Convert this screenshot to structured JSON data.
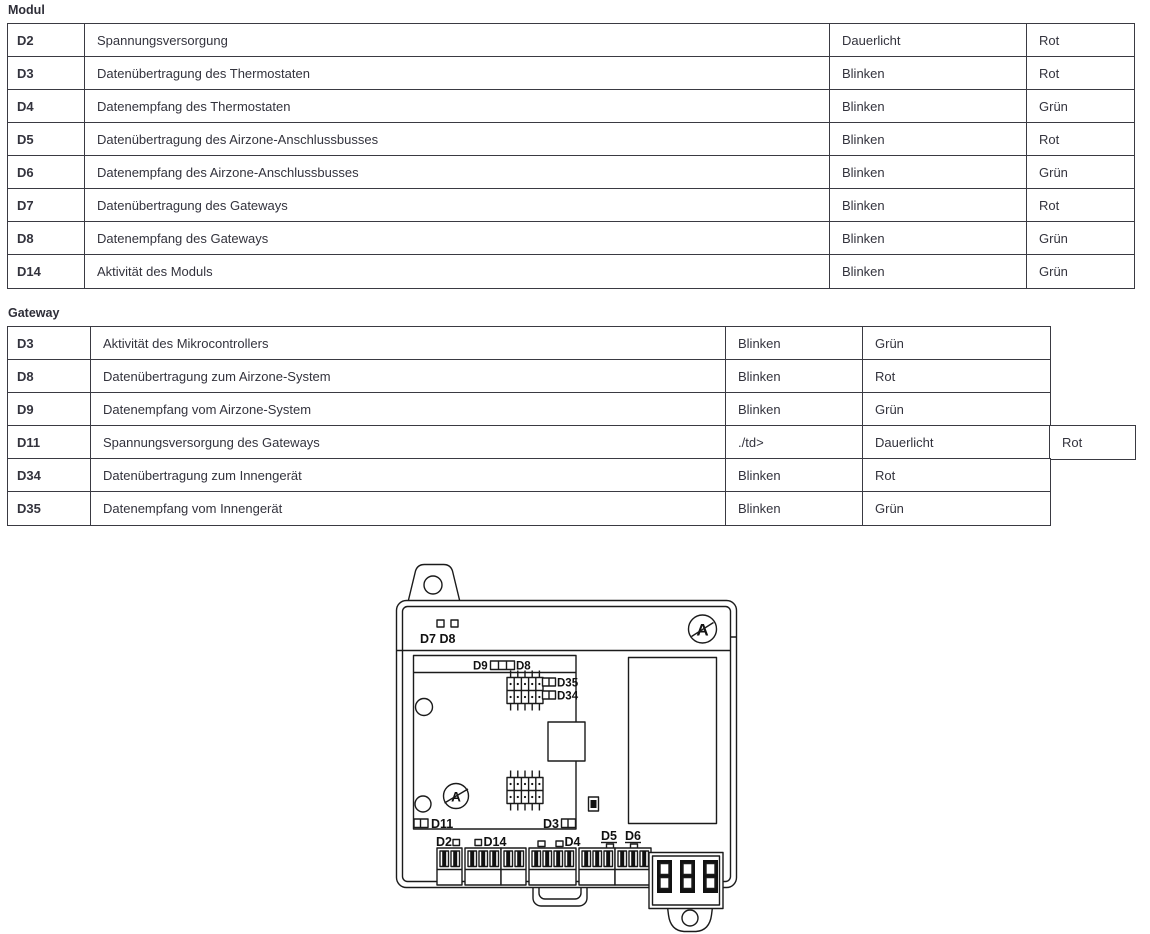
{
  "page": {
    "background": "#ffffff",
    "text_color": "#33333d",
    "border_color": "#3a3a42"
  },
  "modul_table": {
    "title": "Modul",
    "rows": [
      [
        "D2",
        "Spannungsversorgung",
        "Dauerlicht",
        "Rot"
      ],
      [
        "D3",
        "Datenübertragung des Thermostaten",
        "Blinken",
        "Rot"
      ],
      [
        "D4",
        "Datenempfang des Thermostaten",
        "Blinken",
        "Grün"
      ],
      [
        "D5",
        "Datenübertragung des Airzone-Anschlussbusses",
        "Blinken",
        "Rot"
      ],
      [
        "D6",
        "Datenempfang des Airzone-Anschlussbusses",
        "Blinken",
        "Grün"
      ],
      [
        "D7",
        "Datenübertragung des Gateways",
        "Blinken",
        "Rot"
      ],
      [
        "D8",
        "Datenempfang des Gateways",
        "Blinken",
        "Grün"
      ],
      [
        "D14",
        "Aktivität des Moduls",
        "Blinken",
        "Grün"
      ]
    ]
  },
  "gateway_table": {
    "title": "Gateway",
    "rows": [
      [
        "D3",
        "Aktivität des Mikrocontrollers",
        "Blinken",
        "Grün"
      ],
      [
        "D8",
        "Datenübertragung zum Airzone-System",
        "Blinken",
        "Rot"
      ],
      [
        "D9",
        "Datenempfang vom Airzone-System",
        "Blinken",
        "Grün"
      ],
      [
        "D11",
        "Spannungsversorgung des Gateways",
        "./td>",
        "Dauerlicht",
        "Rot"
      ],
      [
        "D34",
        "Datenübertragung zum Innengerät",
        "Blinken",
        "Rot"
      ],
      [
        "D35",
        "Datenempfang vom Innengerät",
        "Blinken",
        "Grün"
      ]
    ]
  },
  "diagram": {
    "labels": {
      "top_leds": "D7 D8",
      "d9": "D9",
      "d8": "D8",
      "d35": "D35",
      "d34": "D34",
      "d11": "D11",
      "d3": "D3",
      "d2": "D2",
      "d14": "D14",
      "d4": "D4",
      "d5": "D5",
      "d6": "D6",
      "logo": "A",
      "board_logo": "A"
    }
  }
}
